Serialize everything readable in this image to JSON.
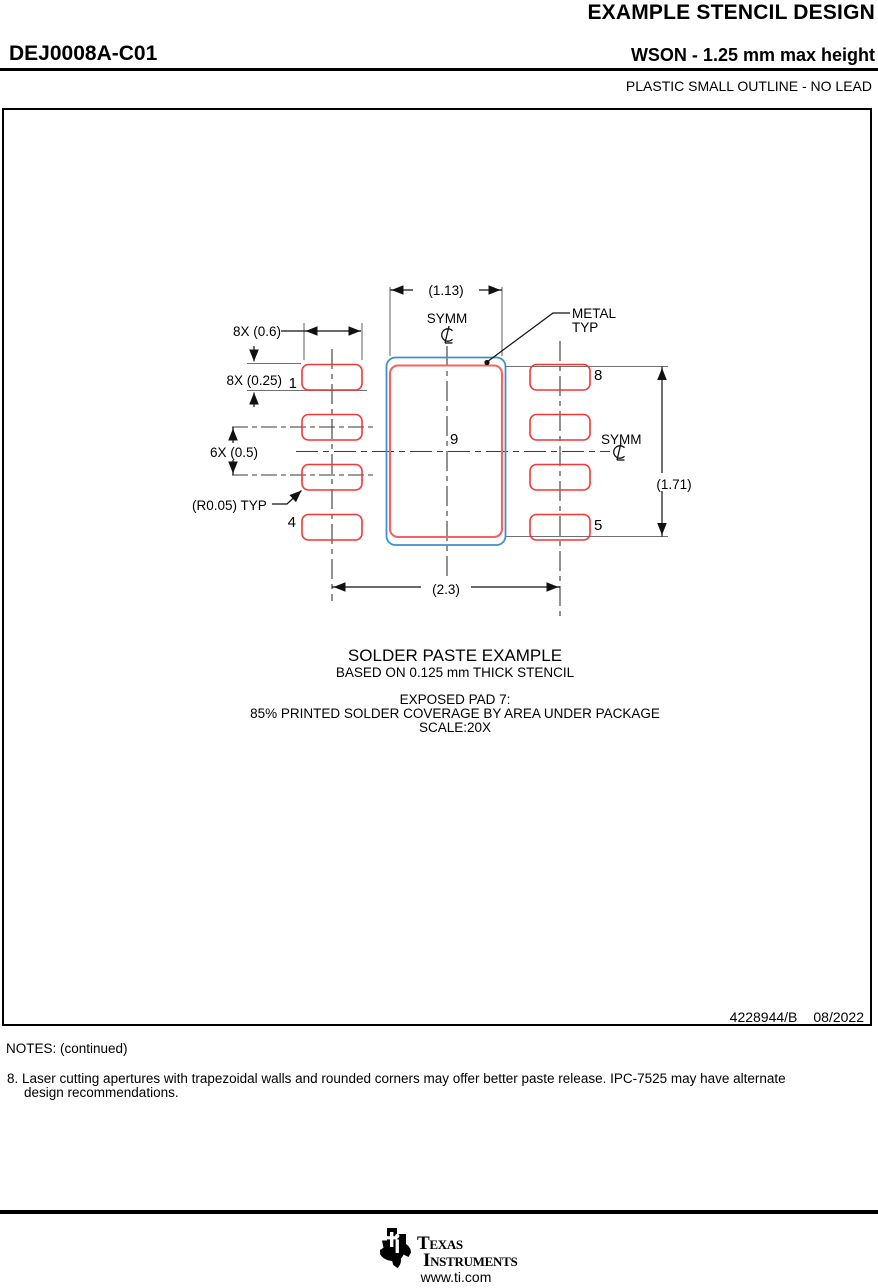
{
  "header": {
    "doc_title": "EXAMPLE STENCIL DESIGN",
    "part_number": "DEJ0008A-C01",
    "package_title": "WSON - 1.25 mm max height",
    "package_subtitle": "PLASTIC SMALL OUTLINE - NO LEAD"
  },
  "diagram": {
    "dim_top_width": "(1.13)",
    "dim_pad_width": "8X (0.6)",
    "dim_pad_height": "8X (0.25)",
    "dim_pitch": "6X (0.5)",
    "dim_radius": "(R0.05) TYP",
    "dim_span": "(2.3)",
    "dim_height": "(1.71)",
    "symm_label_top": "SYMM",
    "symm_label_right": "SYMM",
    "metal_label_1": "METAL",
    "metal_label_2": "TYP",
    "pin_1": "1",
    "pin_4": "4",
    "pin_5": "5",
    "pin_8": "8",
    "pad_9": "9",
    "colors": {
      "paste_red": "#f43737",
      "center_paste_red": "#f96060",
      "metal_blue": "#3f8fd2"
    }
  },
  "caption": {
    "line1": "SOLDER PASTE EXAMPLE",
    "line2": "BASED ON 0.125 mm THICK STENCIL",
    "line3": "EXPOSED PAD 7:",
    "line4": "85% PRINTED SOLDER COVERAGE BY AREA UNDER PACKAGE",
    "line5": "SCALE:20X"
  },
  "title_block": {
    "doc_number": "4228944/B",
    "doc_date": "08/2022"
  },
  "notes": {
    "heading": "NOTES: (continued)",
    "note8_line1": "8. Laser cutting apertures with trapezoidal walls and rounded corners may offer better paste release. IPC-7525 may have alternate",
    "note8_line2": "design recommendations."
  },
  "footer": {
    "brand_line1": "Texas",
    "brand_line2": "Instruments",
    "url": "www.ti.com"
  }
}
